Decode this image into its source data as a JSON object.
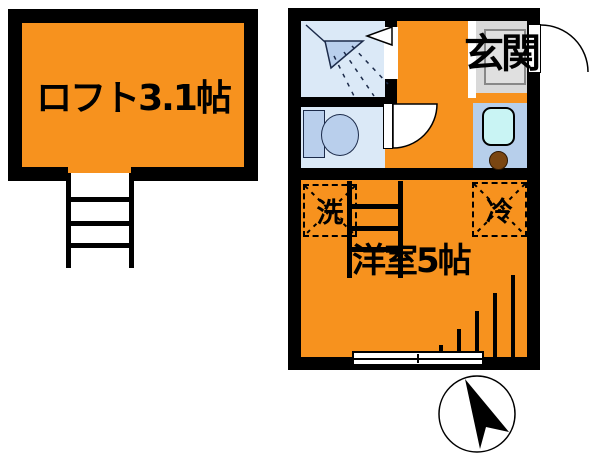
{
  "type": "apartment-floor-plan",
  "rooms": {
    "loft": {
      "label": "ロフト3.1帖",
      "size_jo": 3.1
    },
    "main_room": {
      "label": "洋室5帖",
      "size_jo": 5
    },
    "entrance": {
      "label": "玄関"
    }
  },
  "appliances": {
    "washer": {
      "label": "洗"
    },
    "fridge": {
      "label": "冷"
    }
  },
  "icons": {
    "shower": "shower-head-icon",
    "toilet": "toilet-icon",
    "sink": "kitchen-sink-icon",
    "burner": "stove-burner-icon",
    "loft_ladder": "ladder-icon",
    "room_ladder": "ladder-icon",
    "window": "sliding-window-icon",
    "toilet_door": "door-swing-icon",
    "entrance_door": "door-swing-icon",
    "compass": "north-arrow-compass-icon"
  },
  "colors": {
    "room_fill": "#F7921E",
    "wall": "#000000",
    "wet_fill": "#DBE9F7",
    "fixture_fill": "#B9CFEC",
    "kitchen_fill": "#B7CFEB",
    "sink_fill": "#C9F4F4",
    "burner_fill": "#7A4612",
    "entrance_floor": "#D9D9D9"
  }
}
